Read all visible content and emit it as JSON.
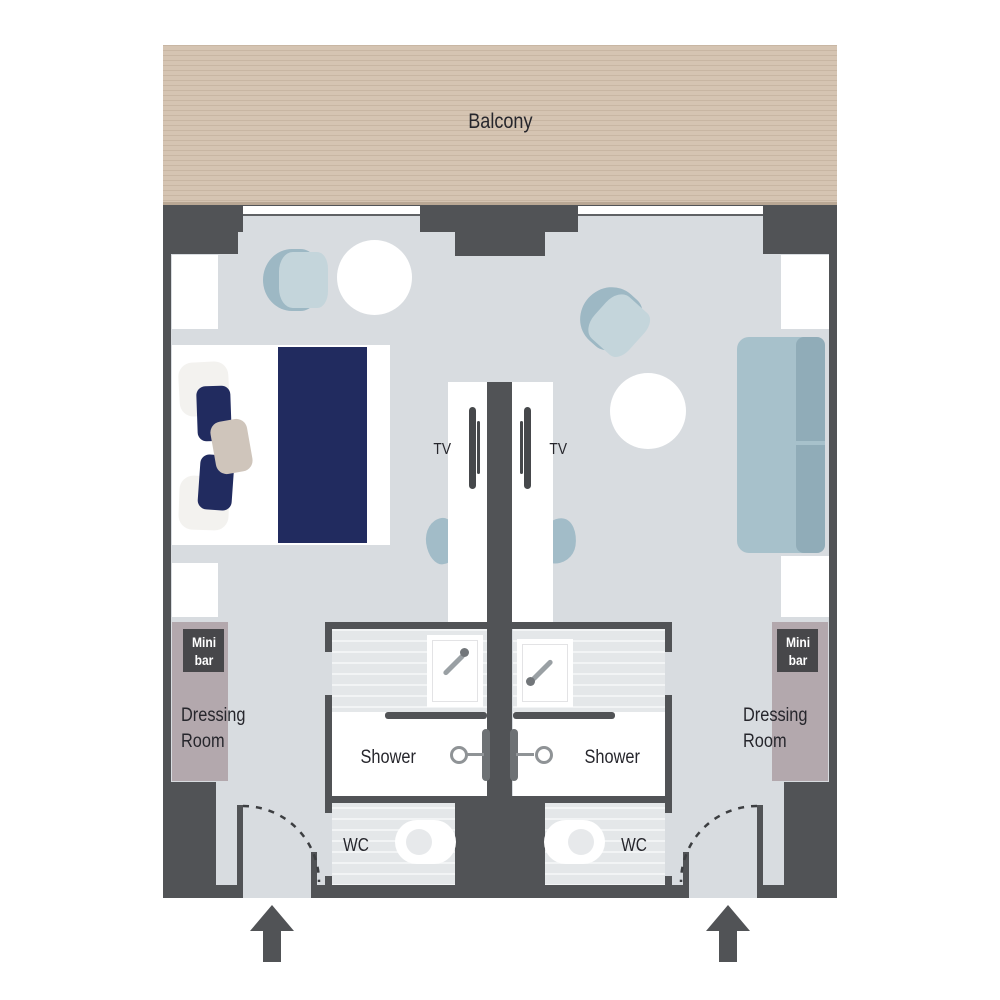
{
  "balcony": {
    "label": "Balcony"
  },
  "rooms": [
    {
      "side": "left",
      "tv_label": "TV",
      "minibar_line1": "Mini",
      "minibar_line2": "bar",
      "dressing_line1": "Dressing",
      "dressing_line2": "Room",
      "shower_label": "Shower",
      "wc_label": "WC"
    },
    {
      "side": "right",
      "tv_label": "TV",
      "minibar_line1": "Mini",
      "minibar_line2": "bar",
      "dressing_line1": "Dressing",
      "dressing_line2": "Room",
      "shower_label": "Shower",
      "wc_label": "WC"
    }
  ],
  "colors": {
    "wall": "#515356",
    "floor": "#d8dce0",
    "balcony": "#d5c4b2",
    "balcony_line": "#c8b6a3",
    "furniture_blue": "#a7c1cb",
    "furniture_blue_light": "#c4d5db",
    "navy": "#212b5f",
    "wardrobe": "#b3a8ad",
    "badge_bg": "#47474a",
    "badge_text": "#ffffff",
    "label_text": "#26262c"
  }
}
